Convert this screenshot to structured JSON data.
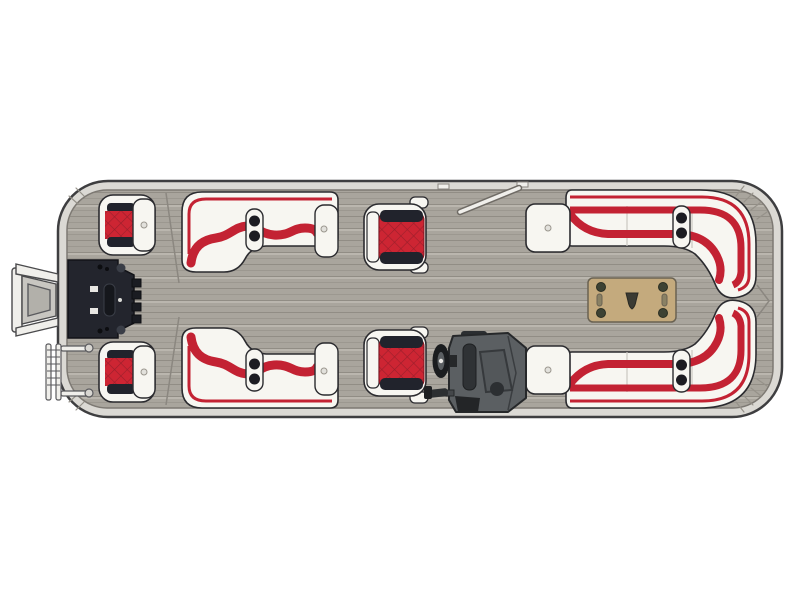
{
  "image": {
    "alt": "Overhead floor plan diagram of a pontoon boat with red and white upholstery on a gray teak-plank deck: outboard motor and boarding ladder at the stern, two rear fishing seats, stern equipment hatch, mirrored mid L-shaped lounges with cup-holder armrests, two red captain chairs, helm console with steering wheel, wraparound bow lounges with chaise backrests, an open side gate, and a tan cocktail table with emblem."
  },
  "palette": {
    "pageBg": "#ffffff",
    "hullBand": "#dbd9d4",
    "hullStroke": "#3e3e40",
    "trimStroke": "#7d7973",
    "deckBase": "#a9a59d",
    "deckLine": "#918d85",
    "deckLineSoft": "#9c9890",
    "deckLight": "#bab6ae",
    "seatWhite": "#f7f6f1",
    "seatStroke": "#2b2b2f",
    "red": "#c32233",
    "cushionRed": "#cd2533",
    "darkBand": "#21232c",
    "tableTan": "#c4aa7d",
    "tableStroke": "#6a6252",
    "bolt": "#3d4233",
    "consoleBody": "#5b5f62",
    "consoleMid": "#53575a",
    "consoleDark": "#2c2f32",
    "panel": "#23252d",
    "metal": "#f0efeb"
  },
  "parts": {
    "hull": "Pontoon hull and rub rail",
    "deck": "Teak-style deck flooring",
    "motor": "Outboard motor",
    "panel": "Stern equipment hatch",
    "ladder": "Boarding ladder",
    "seat_rear_top": "Rear fishing seat (port)",
    "seat_rear_bottom": "Rear fishing seat (starboard)",
    "lounge_mid_top": "Port mid L-lounge",
    "lounge_mid_bottom": "Starboard mid L-lounge",
    "chair_top": "Companion captain chair",
    "chair_bottom": "Helm captain chair",
    "console": "Helm console",
    "wheel": "Steering wheel",
    "lounge_bow_top": "Port bow wraparound lounge",
    "lounge_bow_bottom": "Starboard bow wraparound lounge",
    "cap_top": "Port chaise backrest",
    "cap_bottom": "Starboard chaise backrest",
    "table": "Cocktail table with emblem",
    "gate": "Side boarding gate (open)"
  }
}
